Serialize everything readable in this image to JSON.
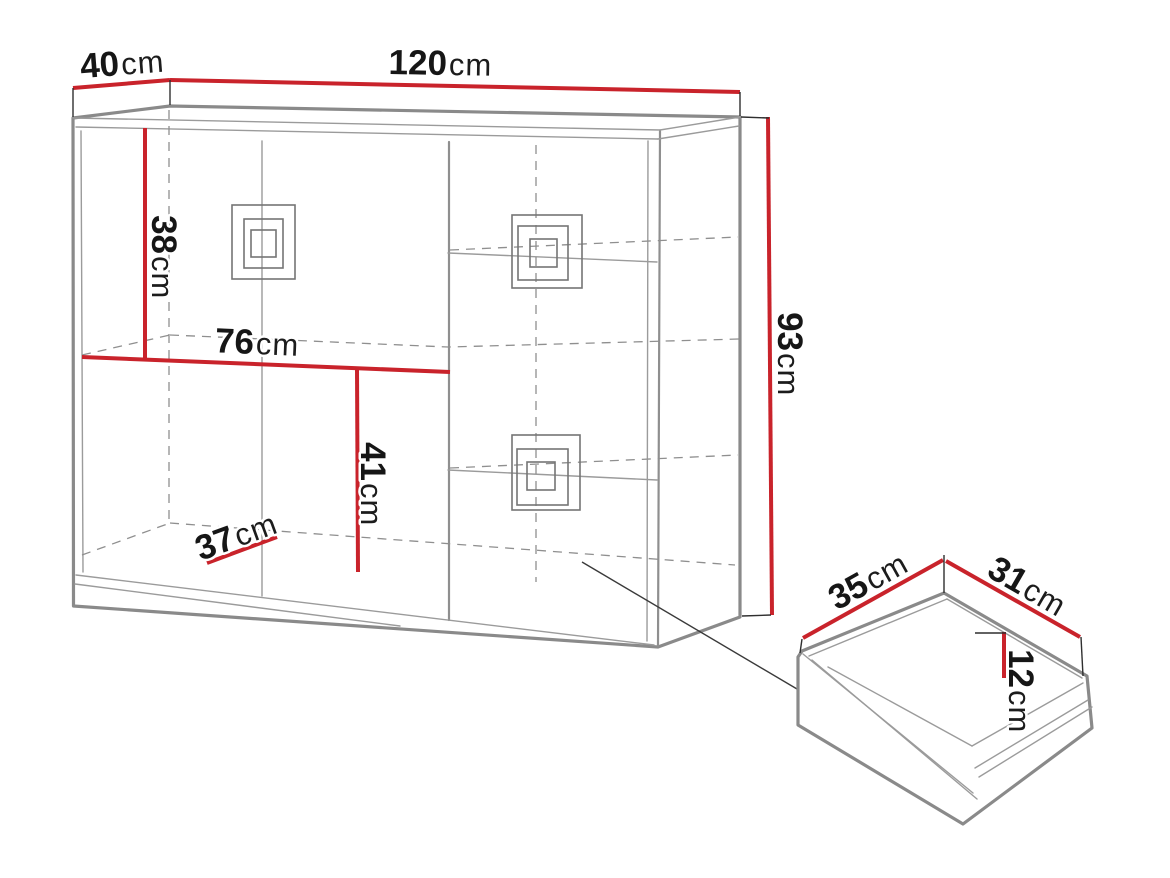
{
  "diagram": {
    "kind": "furniture-dimension-diagram",
    "background": "#ffffff",
    "colors": {
      "dimension_line": "#c9232b",
      "outline": "#8a8a8a",
      "hidden_line": "#8f8f8f",
      "tick_line": "#2f2f2f",
      "label_text": "#161616"
    },
    "cabinet": {
      "name": "chest-of-drawers",
      "dimensions": {
        "depth": {
          "num": "40",
          "unit": "cm",
          "label": "40cm"
        },
        "width": {
          "num": "120",
          "unit": "cm",
          "label": "120cm"
        },
        "upper_section_height": {
          "num": "38",
          "unit": "cm",
          "label": "38cm"
        },
        "left_section_width": {
          "num": "76",
          "unit": "cm",
          "label": "76cm"
        },
        "lower_section_height": {
          "num": "41",
          "unit": "cm",
          "label": "41cm"
        },
        "interior_depth": {
          "num": "37",
          "unit": "cm",
          "label": "37cm"
        },
        "height": {
          "num": "93",
          "unit": "cm",
          "label": "93cm"
        }
      }
    },
    "drawer": {
      "name": "drawer-detail",
      "dimensions": {
        "width": {
          "num": "35",
          "unit": "cm",
          "label": "35cm"
        },
        "depth": {
          "num": "31",
          "unit": "cm",
          "label": "31cm"
        },
        "height": {
          "num": "12",
          "unit": "cm",
          "label": "12cm"
        }
      }
    }
  }
}
